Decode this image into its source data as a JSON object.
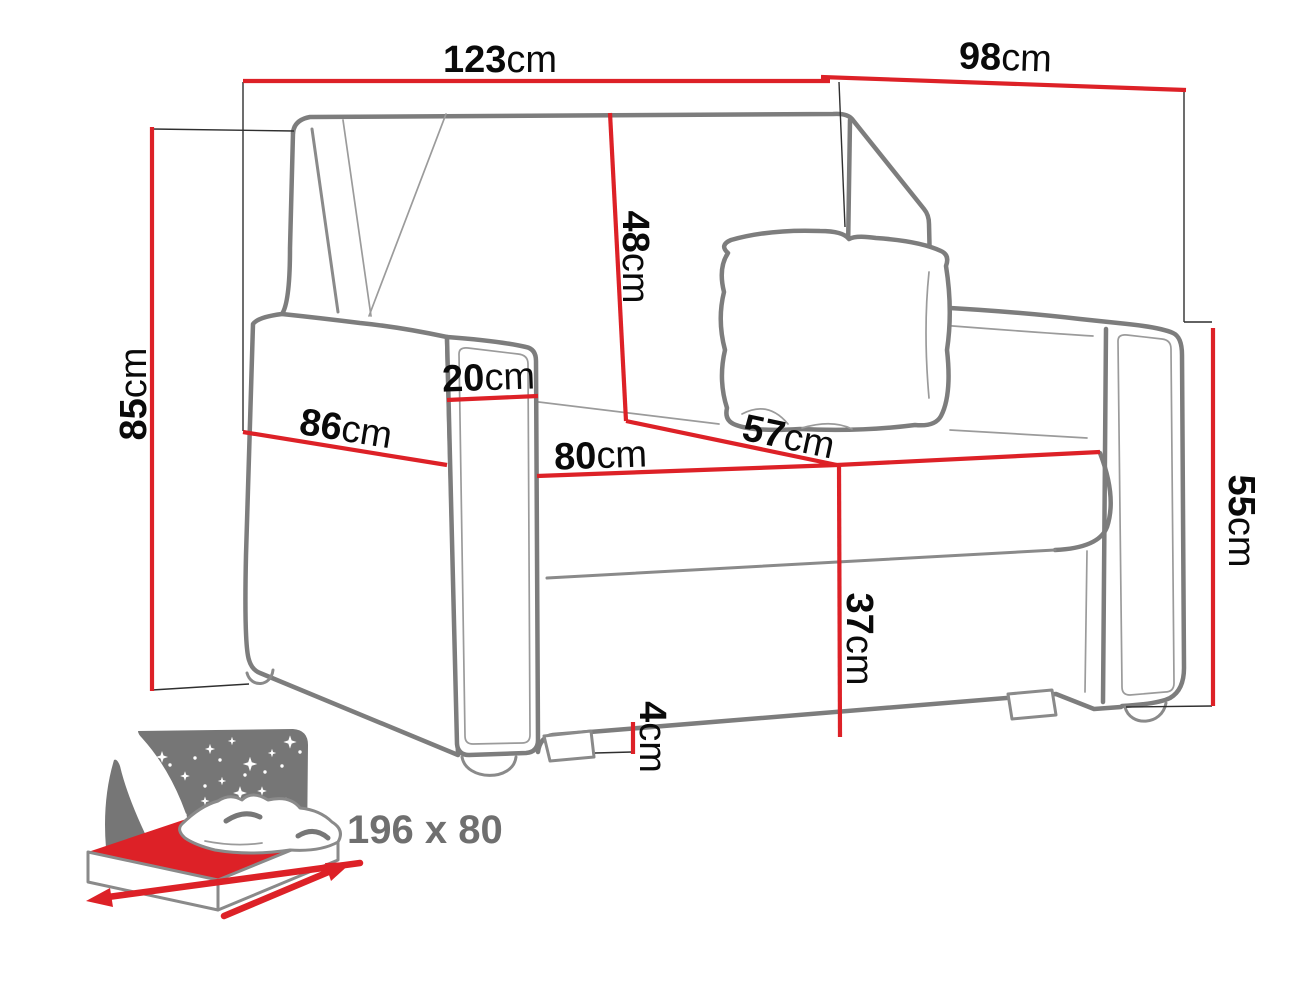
{
  "diagram": {
    "kind": "sofa-bed dimension diagram",
    "colors": {
      "dimension_red": "#dd2127",
      "outline_gray": "#7d7d7d",
      "label_black": "#0a0a0a",
      "icon_gray": "#767676"
    },
    "dims": {
      "width_top": {
        "value": "123",
        "unit": "cm"
      },
      "depth_top": {
        "value": "98",
        "unit": "cm"
      },
      "height_left": {
        "value": "85",
        "unit": "cm"
      },
      "backrest": {
        "value": "48",
        "unit": "cm"
      },
      "armrest_width": {
        "value": "20",
        "unit": "cm"
      },
      "side_depth": {
        "value": "86",
        "unit": "cm"
      },
      "seat_width": {
        "value": "80",
        "unit": "cm"
      },
      "seat_depth": {
        "value": "57",
        "unit": "cm"
      },
      "seat_height": {
        "value": "37",
        "unit": "cm"
      },
      "leg_height": {
        "value": "4",
        "unit": "cm"
      },
      "armrest_height": {
        "value": "55",
        "unit": "cm"
      }
    },
    "sleeping": {
      "label": "196 x 80"
    }
  }
}
